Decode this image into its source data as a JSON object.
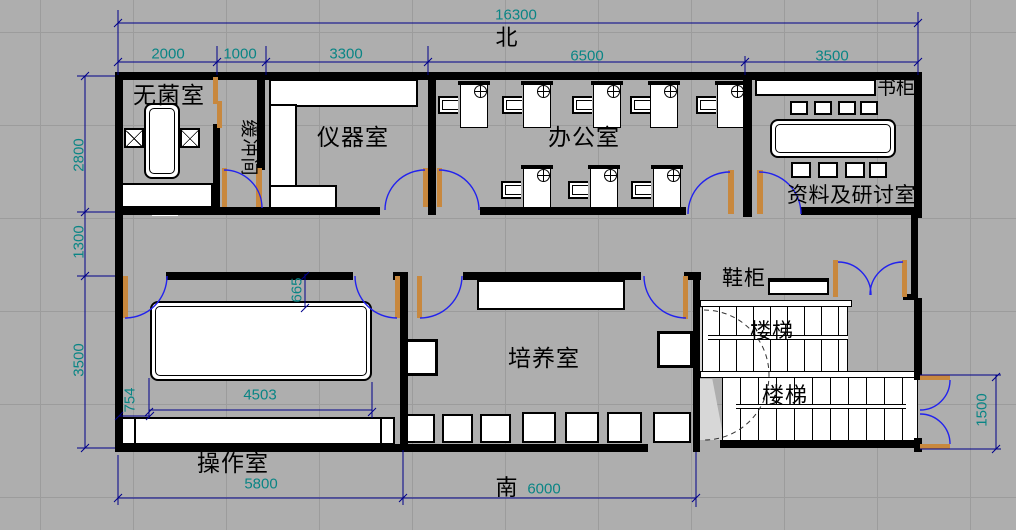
{
  "drawing": {
    "compass": {
      "north": "北",
      "south": "南"
    },
    "rooms": [
      {
        "id": "sterile-room",
        "label": "无菌室"
      },
      {
        "id": "buffer-room",
        "label": "缓冲间"
      },
      {
        "id": "instrument-room",
        "label": "仪器室"
      },
      {
        "id": "office",
        "label": "办公室"
      },
      {
        "id": "bookcase",
        "label": "书柜"
      },
      {
        "id": "archive-seminar-room",
        "label": "资料及研讨室"
      },
      {
        "id": "shoe-cabinet",
        "label": "鞋柜"
      },
      {
        "id": "stairs-upper",
        "label": "楼梯"
      },
      {
        "id": "stairs-lower",
        "label": "楼梯"
      },
      {
        "id": "culture-room",
        "label": "培养室"
      },
      {
        "id": "operation-room",
        "label": "操作室"
      }
    ],
    "dimensions": {
      "total_width": "16300",
      "top_segments": [
        "2000",
        "1000",
        "3300",
        "6500",
        "3500"
      ],
      "left_segments": [
        "2800",
        "1300",
        "3500"
      ],
      "bottom_segments": [
        "5800",
        "6000"
      ],
      "entry_door": "1500",
      "table_offset_left": "754",
      "table_length": "4503",
      "table_offset_top": "665"
    },
    "colors": {
      "background": "#aeaeae",
      "wall": "#000000",
      "dimension_line": "#00008b",
      "dimension_text": "#0a8585",
      "door_arc": "#2222ee",
      "door_leaf": "#c8883e",
      "furniture_fill": "#ffffff"
    }
  }
}
